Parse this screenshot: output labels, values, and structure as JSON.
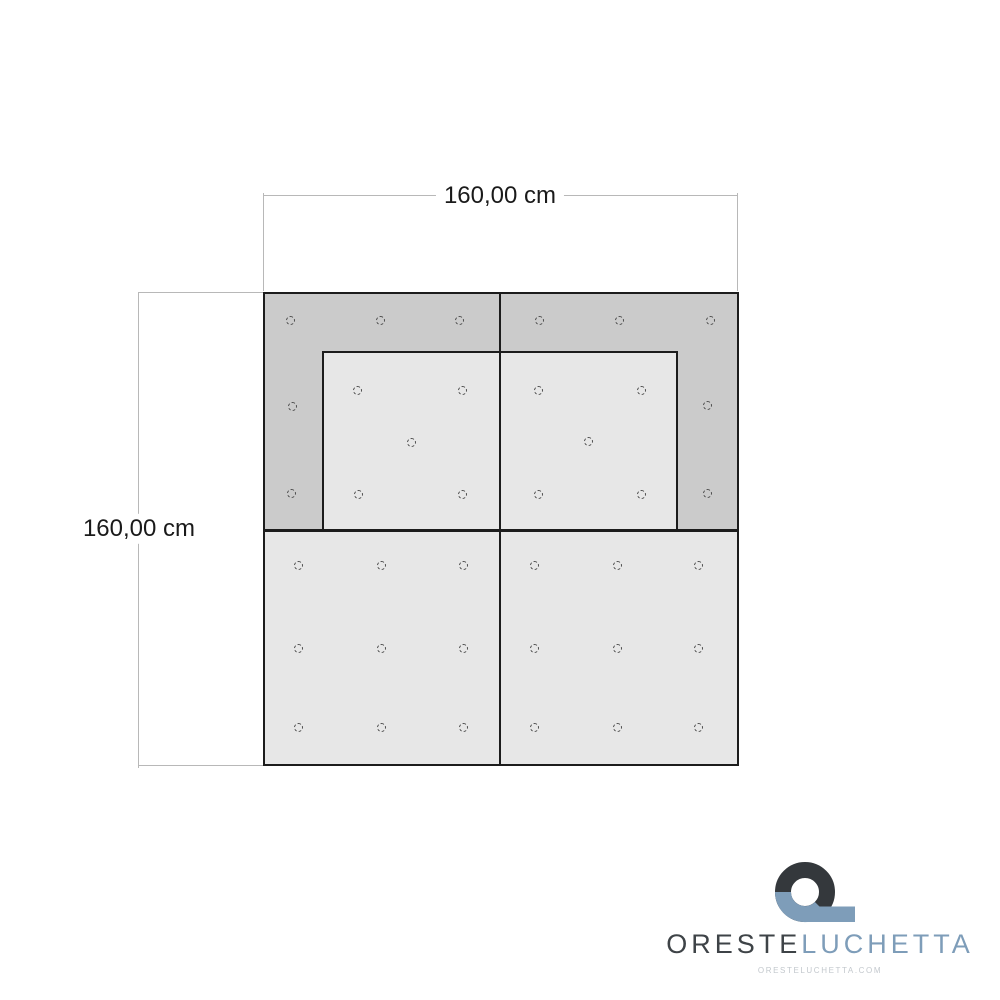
{
  "diagram": {
    "dim_top": {
      "label": "160,00 cm"
    },
    "dim_left": {
      "label": "160,00 cm"
    },
    "colors": {
      "outline": "#1c1c1c",
      "panel_dark": "#cbcbcb",
      "panel_light": "#e7e7e7",
      "dim_line": "#b8b8b8",
      "hole_outline": "#4d4d4d"
    },
    "holes": {
      "top_frame": [
        [
          290,
          320
        ],
        [
          380,
          320
        ],
        [
          459,
          320
        ],
        [
          539,
          320
        ],
        [
          619,
          320
        ],
        [
          710,
          320
        ],
        [
          292,
          406
        ],
        [
          707,
          405
        ],
        [
          291,
          493
        ],
        [
          707,
          493
        ]
      ],
      "inner_panel": [
        [
          357,
          390
        ],
        [
          462,
          390
        ],
        [
          538,
          390
        ],
        [
          641,
          390
        ],
        [
          411,
          442
        ],
        [
          588,
          441
        ],
        [
          358,
          494
        ],
        [
          462,
          494
        ],
        [
          538,
          494
        ],
        [
          641,
          494
        ]
      ],
      "bottom_panels": [
        [
          298,
          565
        ],
        [
          381,
          565
        ],
        [
          463,
          565
        ],
        [
          534,
          565
        ],
        [
          617,
          565
        ],
        [
          698,
          565
        ],
        [
          298,
          648
        ],
        [
          381,
          648
        ],
        [
          463,
          648
        ],
        [
          534,
          648
        ],
        [
          617,
          648
        ],
        [
          698,
          648
        ],
        [
          298,
          727
        ],
        [
          381,
          727
        ],
        [
          463,
          727
        ],
        [
          534,
          727
        ],
        [
          617,
          727
        ],
        [
          698,
          727
        ]
      ]
    }
  },
  "logo": {
    "brand_primary": "ORESTE",
    "brand_secondary": "LUCHETTA",
    "website": "ORESTELUCHETTA.COM",
    "colors": {
      "mark_dark": "#34383c",
      "mark_blue": "#7e9db9",
      "text_dark": "#3e4347",
      "text_blue": "#7e9db9",
      "website_gray": "#c3c8cd"
    }
  }
}
